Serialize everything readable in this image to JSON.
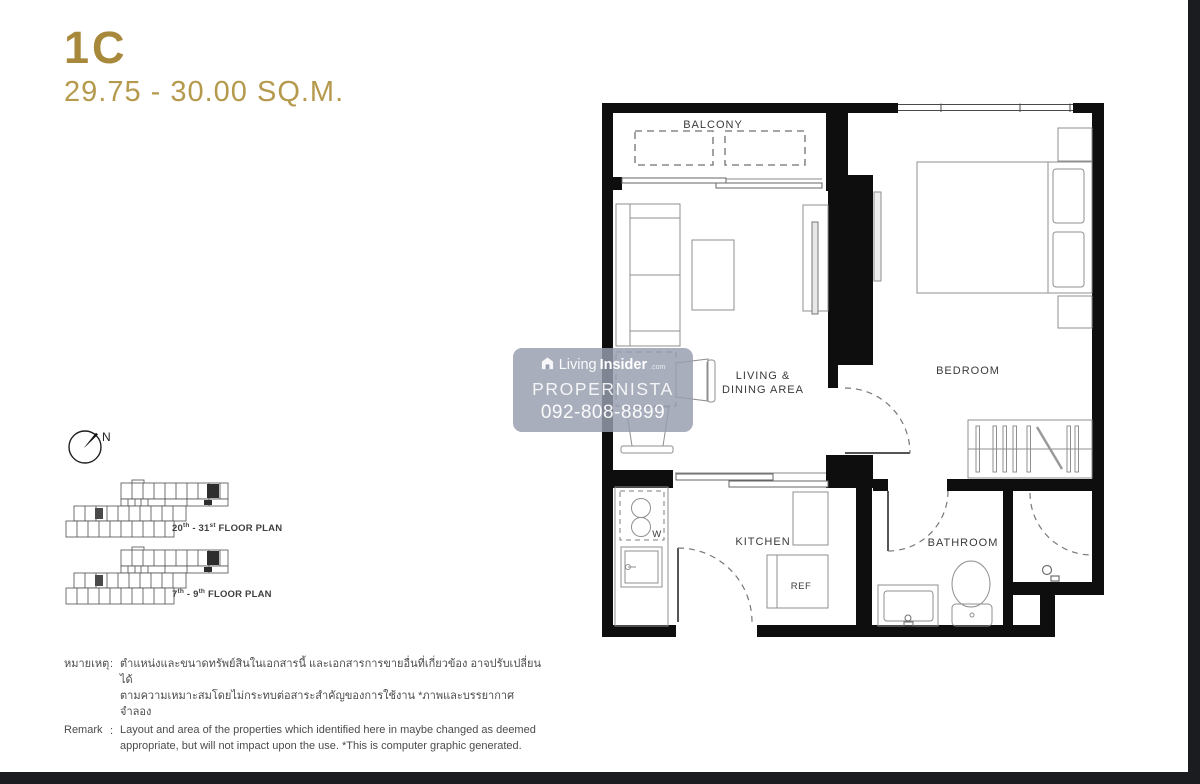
{
  "header": {
    "unit_name": "1C",
    "area_range": "29.75 - 30.00 SQ.M."
  },
  "compass": {
    "north_label": "N"
  },
  "key_plans": [
    {
      "pre": "20",
      "sup1": "th",
      "mid": " - 31",
      "sup2": "st",
      "post": " FLOOR PLAN"
    },
    {
      "pre": "7",
      "sup1": "th",
      "mid": " - 9",
      "sup2": "th",
      "post": " FLOOR PLAN"
    }
  ],
  "floor_plan": {
    "rooms": {
      "balcony": "BALCONY",
      "living_line1": "LIVING &",
      "living_line2": "DINING AREA",
      "bedroom": "BEDROOM",
      "kitchen": "KITCHEN",
      "bathroom": "BATHROOM",
      "ref": "REF",
      "washer": "W"
    }
  },
  "watermark": {
    "brand_living": "Living",
    "brand_insider": "Insider",
    "brand_tld": ".com",
    "name": "PROPERNISTA",
    "phone": "092-808-8899"
  },
  "remark": {
    "colon": ":",
    "thai_label": "หมายเหตุ",
    "thai_line1": "ตำแหน่งและขนาดทรัพย์สินในเอกสารนี้ และเอกสารการขายอื่นที่เกี่ยวข้อง อาจปรับเปลี่ยนได้",
    "thai_line2": "ตามความเหมาะสมโดยไม่กระทบต่อสาระสำคัญของการใช้งาน *ภาพและบรรยากาศจำลอง",
    "en_label": "Remark",
    "en_line1": "Layout and area of the properties which identified here in maybe changed as deemed",
    "en_line2": "appropriate, but will not impact upon the use. *This is computer graphic generated."
  },
  "colors": {
    "gold_title": "#a8893c",
    "gold_subtitle": "#b59a4d",
    "wall_black": "#0e0e0e",
    "edge_strip": "#1a1c20",
    "watermark_bg": "rgba(152,157,176,0.83)"
  }
}
